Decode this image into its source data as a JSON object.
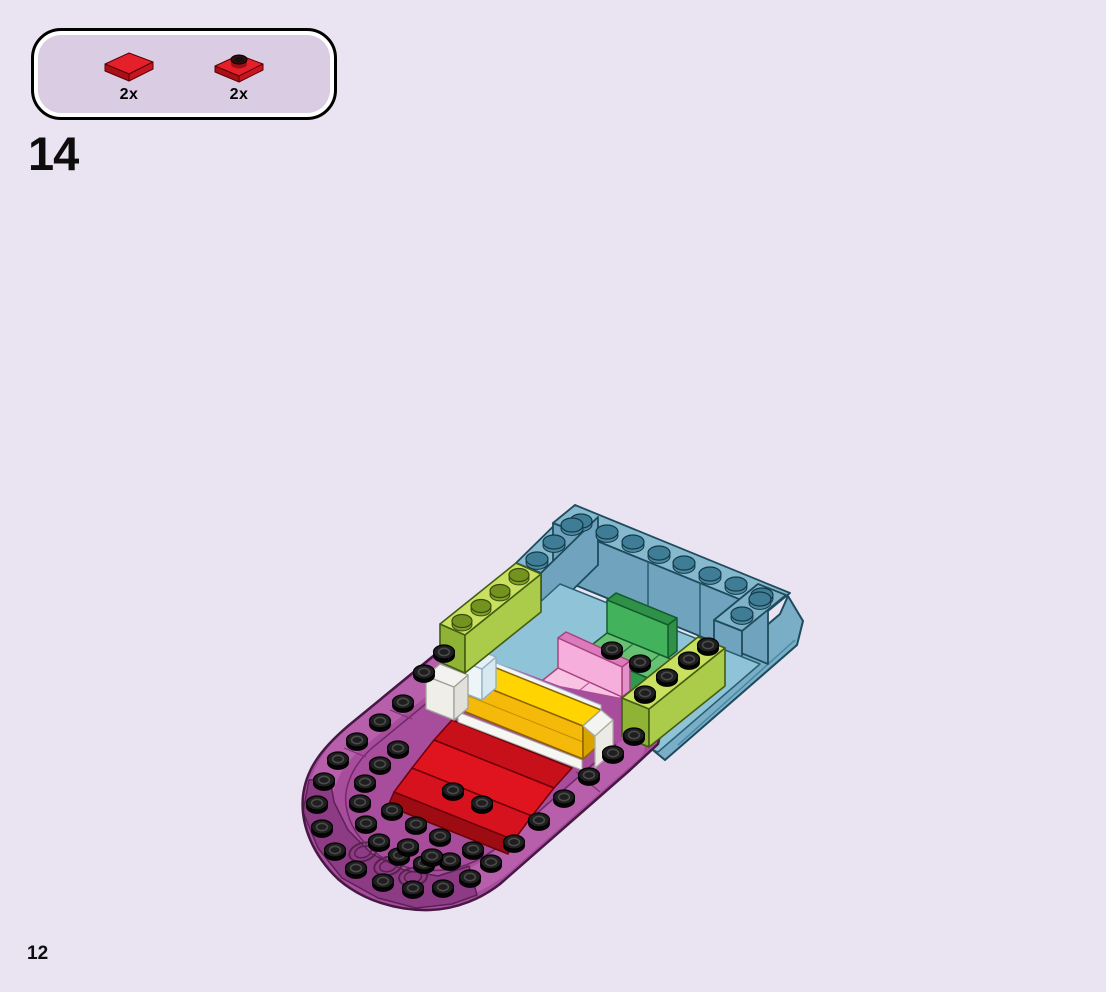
{
  "page": {
    "step_number": "14",
    "page_number": "12",
    "background_color": "#EAE3F1",
    "callout_inner_color": "#D9CCE3"
  },
  "parts_callout": {
    "parts": [
      {
        "name": "red-tile-1x2",
        "count": "2x",
        "color": "#D8141C"
      },
      {
        "name": "red-plate-1x2-with-stud",
        "count": "2x",
        "color": "#D8141C"
      }
    ]
  },
  "model": {
    "name": "boat-hull-assembly",
    "components": [
      "magenta-boat-hull-bow",
      "azure-stern-walls",
      "azure-deck-floor",
      "lime-green-brick-left",
      "lime-green-brick-right",
      "green-bench-seat",
      "pink-bench-seat",
      "yellow-long-brick",
      "transparent-clear-bricks",
      "red-plates-bow"
    ],
    "colors": {
      "hull_magenta": "#A84C9C",
      "hull_magenta_dark": "#8E3B85",
      "hull_rim": "#B85FAB",
      "deck_azure_top": "#86B8CE",
      "deck_azure_wall": "#6FA3BE",
      "deck_azure_floor": "#8FC3D8",
      "azure_stud_top": "#3E7D95",
      "lime_green": "#C9E060",
      "bench_green": "#42B35C",
      "bench_pink": "#F6AEDC",
      "brick_yellow": "#FFD400",
      "plate_red": "#E0141F",
      "red_dark": "#9E0C13",
      "trans_clear": "#E8F2F8",
      "stud_black": "#1F1F1F",
      "outline": "#471844"
    }
  }
}
